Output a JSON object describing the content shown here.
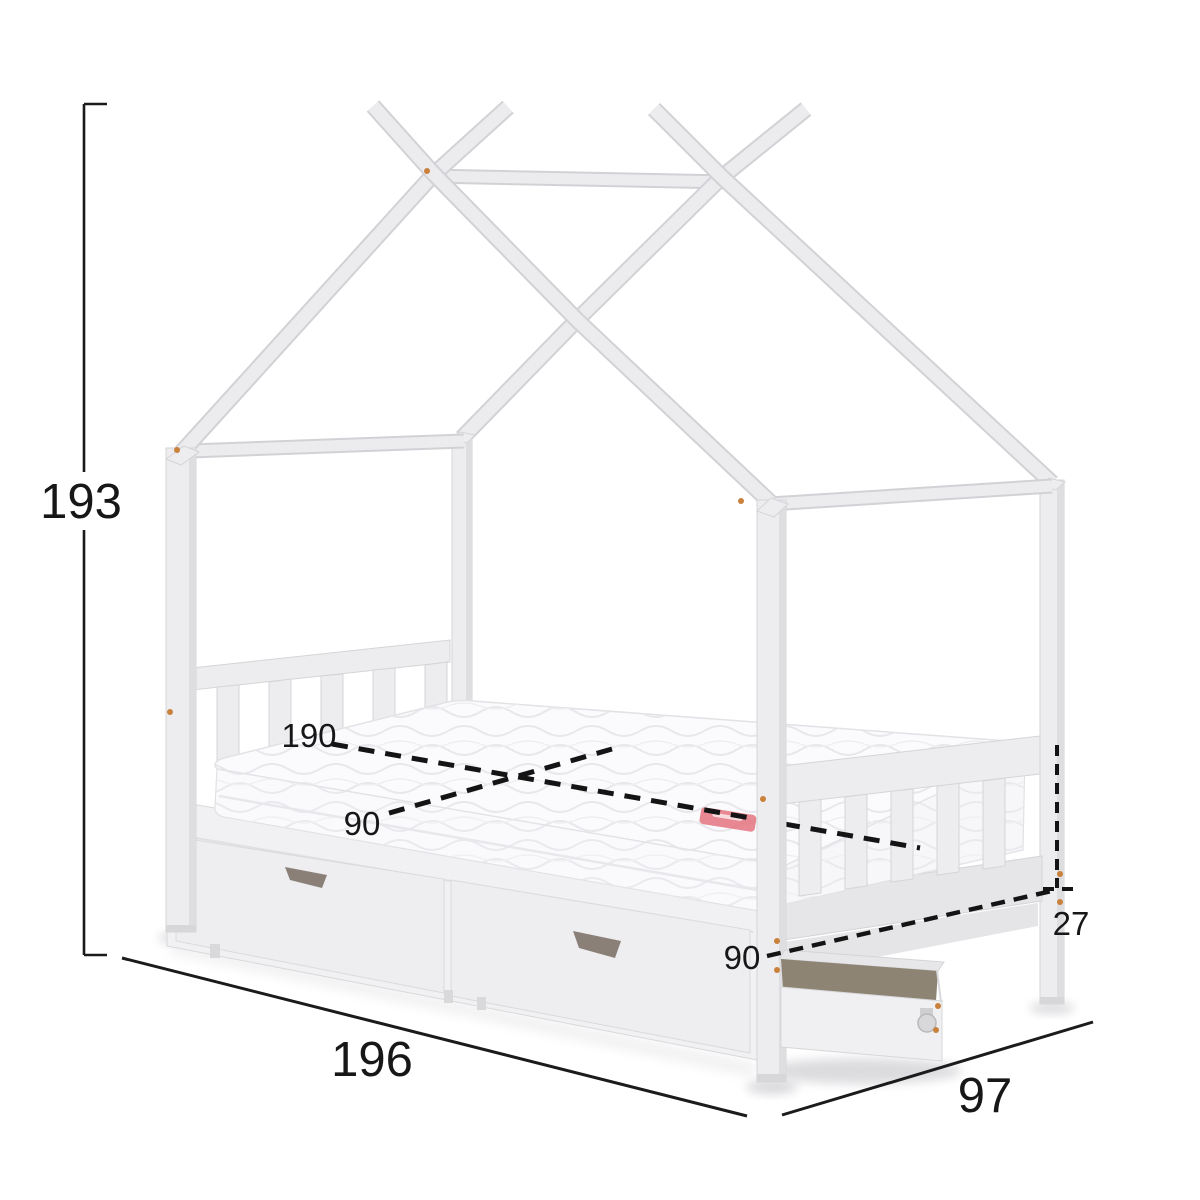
{
  "figure": {
    "kind": "furniture-dimension-diagram",
    "subject": "house-frame kids bed with under-bed drawers and pull-out drawer on caster"
  },
  "annotations": {
    "overall_height": "193",
    "overall_length": "196",
    "overall_width": "97",
    "mattress_length": "190",
    "mattress_width": "90",
    "base_height": "27",
    "foot_end_width": "90"
  },
  "colors": {
    "background": "#ffffff",
    "dimension_lines": "#1b1b1b",
    "furniture_fill": "#ededef",
    "furniture_edge": "#d5d5d8",
    "drawer_interior": "#8e8474",
    "drawer_handle": "#8a8078",
    "screw_dots": "#c9813c",
    "mattress_tag": "#e4737f"
  }
}
